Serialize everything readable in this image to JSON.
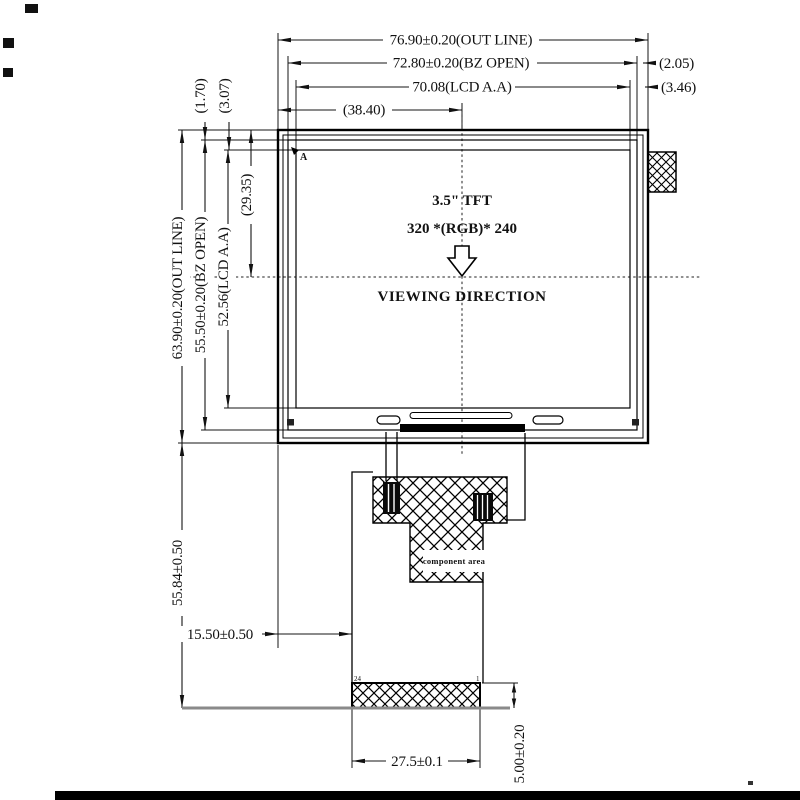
{
  "drawing": {
    "title_block": {
      "module": "3.5\" TFT",
      "resolution": "320 *(RGB)* 240",
      "viewing": "VIEWING DIRECTION"
    },
    "dims_top": {
      "outline": "76.90±0.20(OUT LINE)",
      "bz_open": "72.80±0.20(BZ OPEN)",
      "lcd_aa": "70.08(LCD A.A)",
      "center_offset": "(38.40)"
    },
    "dims_right": {
      "bz_gap": "(2.05)",
      "aa_gap": "(3.46)"
    },
    "dims_left_top": {
      "bz_gap": "(1.70)",
      "aa_gap": "(3.07)"
    },
    "dims_left": {
      "outline": "63.90±0.20(OUT LINE)",
      "bz_open": "55.50±0.20(BZ OPEN)",
      "lcd_aa": "52.56(LCD A.A)",
      "center_offset": "(29.35)"
    },
    "dims_bottom": {
      "fpc_length": "55.84±0.50",
      "fpc_offset": "15.50±0.50",
      "connector_width": "27.5±0.1",
      "connector_height": "5.00±0.20"
    },
    "labels": {
      "corner_marker": "A",
      "component_area": "component area",
      "pin_left": "24",
      "pin_right": "1"
    },
    "colors": {
      "line": "#141414",
      "baseline_gray": "#8a8a8a"
    }
  }
}
